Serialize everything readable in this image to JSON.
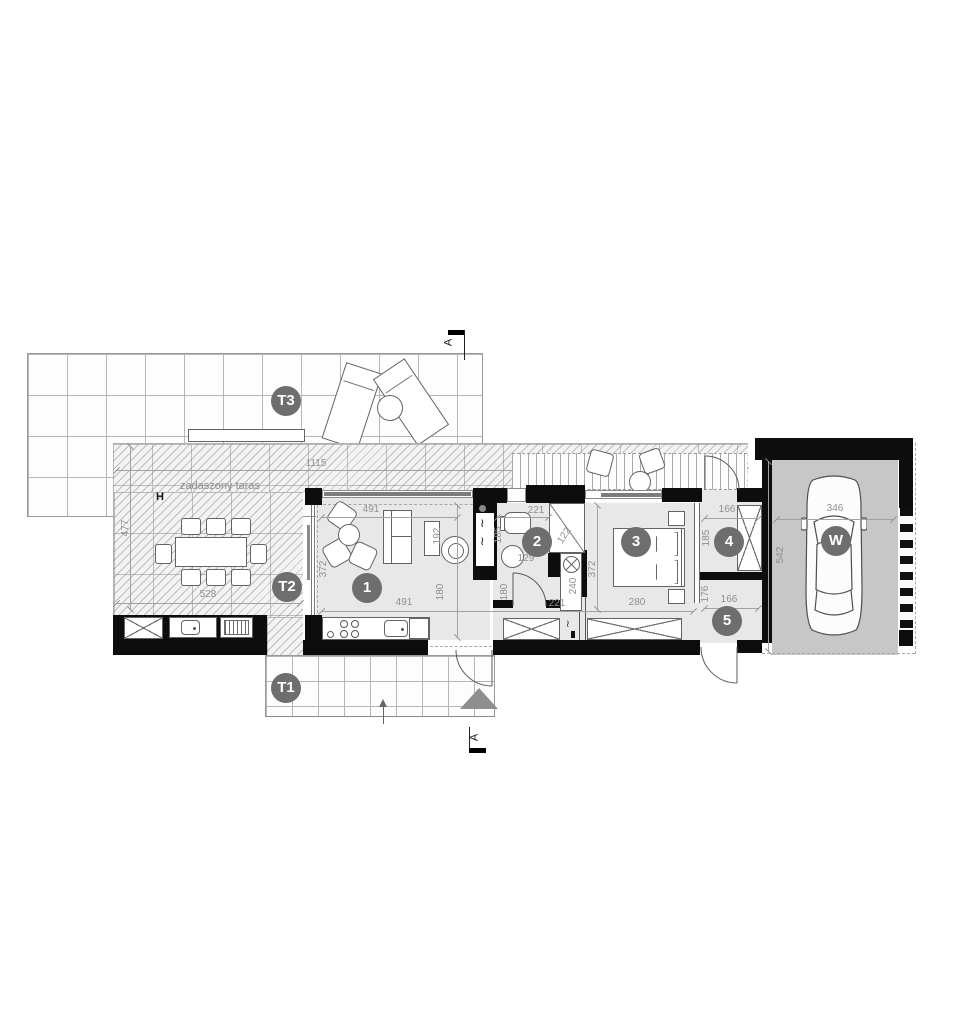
{
  "plan_title": "floor-plan",
  "terraces": {
    "t1": "T1",
    "t2": "T2",
    "t3": "T3",
    "covered_terrace_label": "zadaszony taras",
    "hydrant": "H"
  },
  "rooms": {
    "living": "1",
    "bath": "2",
    "bedroom": "3",
    "storage4": "4",
    "storage5": "5",
    "carport": "W"
  },
  "section": {
    "letter": "A"
  },
  "symbols": {
    "vent": "≀"
  },
  "dims": {
    "terrace": {
      "w": "1115",
      "d": "477",
      "t": "528"
    },
    "living": {
      "top": "491",
      "left": "372",
      "sofa": "192",
      "mid": "180",
      "bottom": "491"
    },
    "bath": {
      "top": "221",
      "left": "185",
      "shower": "122",
      "basin": "129",
      "low": "180",
      "niche": "240",
      "bottom": "221"
    },
    "bedroom": {
      "left": "372",
      "bottom": "280"
    },
    "s4": {
      "w": "166",
      "h": "185"
    },
    "s5": {
      "w": "166",
      "h": "176"
    },
    "carport": {
      "d": "542",
      "w": "346"
    }
  },
  "colors": {
    "wall": "#0d0d0d",
    "floor": "#e8e8e8",
    "carport_floor": "#c7c7c7",
    "badge": "#6e6e6e",
    "dim_text": "#8f8f8f",
    "entrance_triangle": "#8e8e8e",
    "window_bar": "#7c7c7c"
  }
}
